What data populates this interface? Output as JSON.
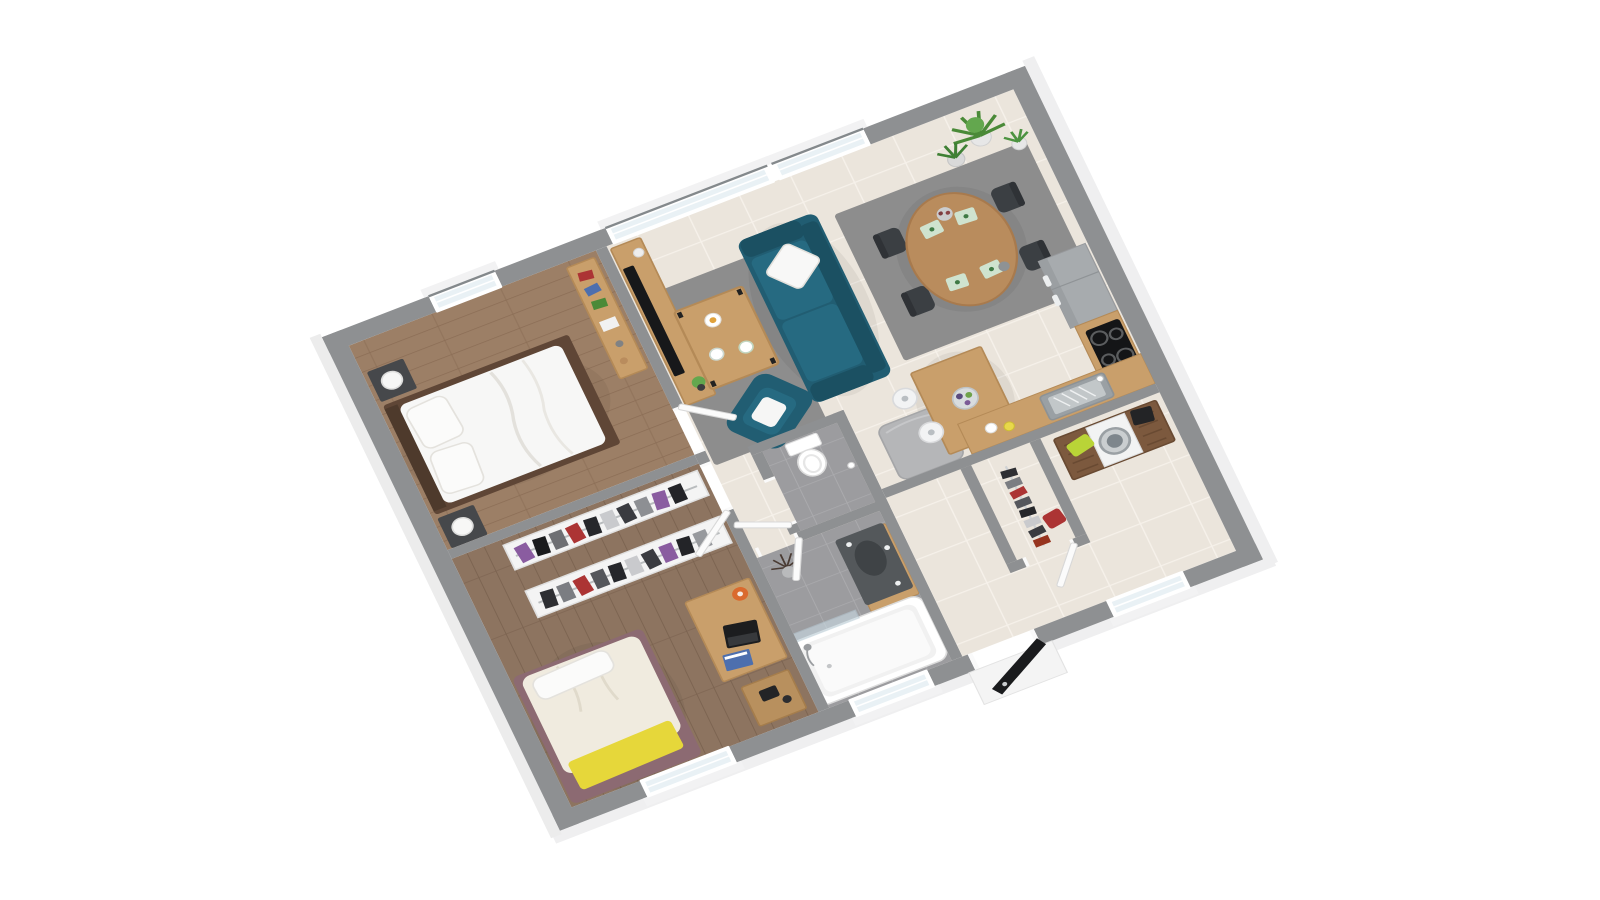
{
  "scene": {
    "kind": "3d-floor-plan-render",
    "view": "isometric-perspective",
    "background": "#ffffff",
    "visible_text": []
  },
  "palette": {
    "wallTop": "#8e9092",
    "wallFace": "#efeff0",
    "frame": "#ffffff",
    "glass": "#e9f1f5",
    "glassEdge": "#424a4f",
    "tile": "#ebe5dc",
    "tileLine": "#f6f1ea",
    "wood1": "#9c7f66",
    "wood1Line": "#8b6d55",
    "wood2": "#8d7460",
    "wood2Line": "#7b6350",
    "bathTile": "#9c9c9f",
    "bathTileLine": "#abababd",
    "rug": "#8d8d8d",
    "woodLight": "#c99f6b",
    "woodLightEdge": "#b48a57",
    "woodMid": "#b98c5d",
    "woodDark": "#7c593e",
    "woodDarkLine": "#694a32",
    "teal": "#215d72",
    "tealDark": "#1b5062",
    "tealLight": "#266a81",
    "white": "#f7f7f6",
    "cream": "#f0ebdf",
    "yellow": "#e6d73a",
    "lime": "#b9d437",
    "mauve": "#8c6a72",
    "darkFurn": "#46484b",
    "chair": "#3b3f43",
    "black": "#1a1b1d",
    "metal": "#b9bec2",
    "steel": "#9aa0a4",
    "orange": "#da6a2e",
    "blue": "#4d6fae",
    "red": "#ac3434",
    "purple": "#8a5ca0",
    "green": "#4a8a38",
    "greenLight": "#63a74e",
    "pot": "#e7e7e7",
    "grayCube": "#b5b6b8",
    "appliance": "#a7abae",
    "cooktop": "#141517"
  },
  "rooms": [
    {
      "id": "living-room",
      "floor": "beige-tile",
      "furniture": [
        "teal-sofa",
        "white-cushion",
        "teal-armchair",
        "gray-rug",
        "wood-coffee-table",
        "tv-bench",
        "flat-tv",
        "plants"
      ]
    },
    {
      "id": "dining-area",
      "floor": "beige-tile",
      "furniture": [
        "oval-wood-table",
        "4-dark-chairs",
        "gray-rug",
        "4-green-placemats",
        "centerpiece",
        "corner-plants"
      ]
    },
    {
      "id": "kitchen",
      "floor": "beige-tile",
      "furniture": [
        "tall-gray-oven-fridge-column",
        "cooktop-counter",
        "sink-counter",
        "kitchen-island",
        "2-white-bar-stools",
        "fruit-bowl",
        "gray-storage-cube"
      ]
    },
    {
      "id": "bedroom-1",
      "floor": "wood",
      "furniture": [
        "double-bed-white-bedding",
        "2-dark-nightstands",
        "2-white-lamps",
        "wood-dresser-with-books",
        "small-window"
      ]
    },
    {
      "id": "bedroom-2",
      "floor": "wood",
      "furniture": [
        "single-bed-cream-bedding",
        "yellow-throw",
        "mauve-bed-frame",
        "2-open-clothes-racks",
        "wood-desk",
        "laptop",
        "orange-lamp",
        "small-cabinet",
        "window"
      ]
    },
    {
      "id": "bathroom",
      "floor": "gray-tile",
      "furniture": [
        "bathtub",
        "glass-shower-screen",
        "dark-vanity-sink",
        "twig-plant",
        "window"
      ]
    },
    {
      "id": "wc",
      "floor": "gray-tile",
      "furniture": [
        "toilet",
        "toilet-paper-holder"
      ]
    },
    {
      "id": "dressing",
      "floor": "beige-tile",
      "furniture": [
        "clothes-rail-with-clothes",
        "red-chair"
      ]
    },
    {
      "id": "utility-room",
      "floor": "beige-tile",
      "furniture": [
        "walnut-sideboard",
        "washing-machine",
        "lime-laundry-basket",
        "black-box",
        "window"
      ]
    },
    {
      "id": "entry-hallway",
      "floor": "beige-tile",
      "furniture": [
        "black-front-door",
        "white-landing"
      ]
    }
  ],
  "openings": {
    "windows": 6,
    "exterior_doors": 1,
    "interior_doors": 6
  }
}
